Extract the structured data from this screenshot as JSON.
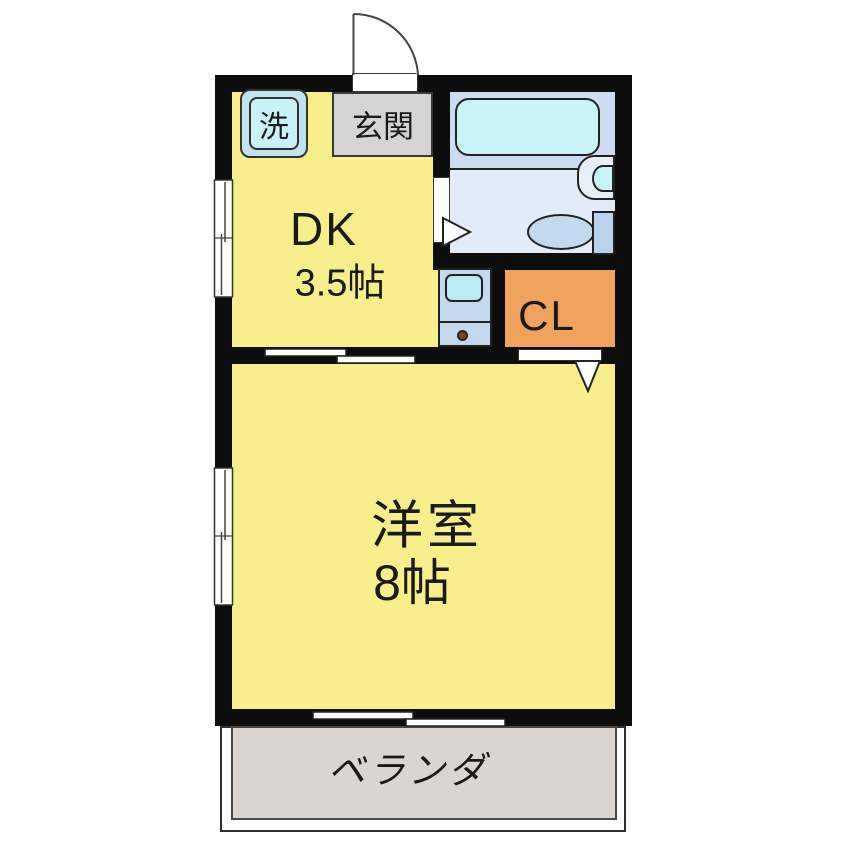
{
  "floorplan": {
    "type": "japanese-apartment-1DK",
    "rooms": {
      "dk": {
        "name": "DK",
        "size": "3.5帖"
      },
      "western_room": {
        "name": "洋室",
        "size": "8帖"
      },
      "genkan": {
        "label": "玄関"
      },
      "laundry": {
        "label": "洗"
      },
      "closet": {
        "label": "CL"
      },
      "veranda": {
        "label": "ベランダ"
      }
    },
    "fixtures": [
      "washing-machine-pan",
      "entrance-door-swing",
      "bathtub",
      "wash-basin",
      "toilet",
      "kitchen-sink-unit",
      "gas-burner",
      "sliding-door",
      "closet-door",
      "bathroom-door",
      "sliding-window"
    ],
    "colors": {
      "wall": "#0d0d0d",
      "room_yellow": "#f8ee8c",
      "genkan_gray": "#d4d4d4",
      "closet_orange": "#efa25d",
      "bath_upper_blue": "#cbddf3",
      "bath_lower_blue": "#e2ecf8",
      "tub_cyan": "#c8f3f7",
      "fixture_blue": "#c4d9f0",
      "sink_cyan": "#b9ecf3",
      "veranda_beige": "#dcd5cf",
      "background": "#ffffff"
    }
  }
}
